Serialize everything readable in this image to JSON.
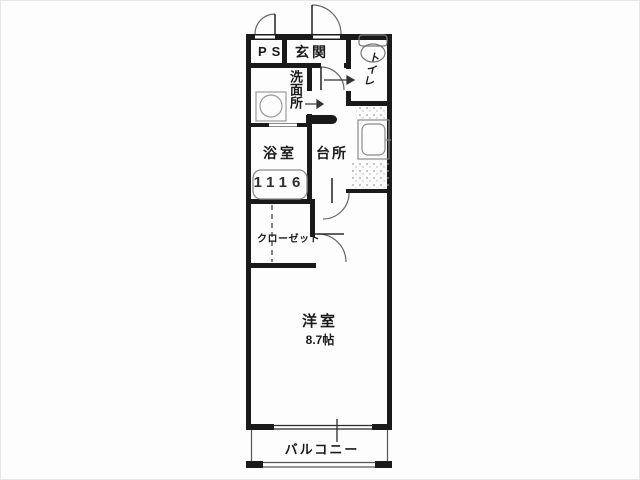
{
  "floorplan": {
    "type": "apartment-floor-plan",
    "rooms": {
      "ps": {
        "label": "PS"
      },
      "genkan": {
        "label": "玄関"
      },
      "toilet": {
        "label": "トイレ"
      },
      "washroom": {
        "label": "洗面所"
      },
      "bathroom": {
        "label": "浴室",
        "unit_size": "1116"
      },
      "kitchen": {
        "label": "台所"
      },
      "closet": {
        "label": "クローゼット"
      },
      "western_room": {
        "label": "洋室",
        "size": "8.7帖"
      },
      "balcony": {
        "label": "バルコニー"
      }
    },
    "fixtures": [
      "toilet-icon",
      "washing-machine-icon",
      "bathtub-icon",
      "kitchen-sink-icon"
    ],
    "symbols": [
      "entry-arrow-toilet",
      "entry-arrow-washroom",
      "door-arc-entrance",
      "door-arc-ps",
      "door-arc-kitchen",
      "door-arc-room",
      "closet-dashed-line",
      "balcony-window"
    ],
    "colors": {
      "wall": "#1a1a1a",
      "thin_line": "#555555",
      "fixture_outline": "#8a8a8a",
      "background": "#ffffff",
      "text": "#1b1b1b"
    }
  }
}
